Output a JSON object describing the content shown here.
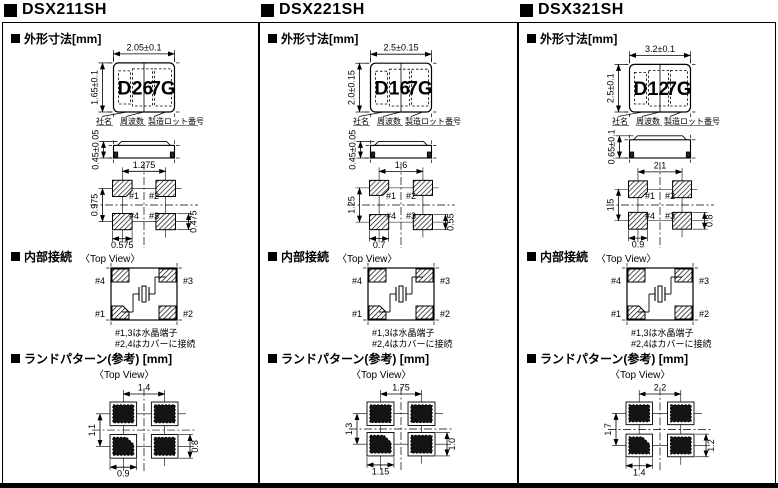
{
  "panels": [
    {
      "title": "DSX211SH",
      "sections": {
        "outline": "外形寸法[mm]",
        "internal": "内部接続",
        "land": "ランドパターン(参考) [mm]"
      },
      "top_view": {
        "width_dim": "2.05±0.1",
        "height_dim": "1.65±0.1",
        "marking": [
          "D",
          "26",
          "7G"
        ],
        "marking_labels": [
          "社名",
          "周波数",
          "製造ロット番号"
        ]
      },
      "side_view": {
        "height_dim": "0.45±0.05"
      },
      "bottom_view": {
        "pitch_x": "1.275",
        "pitch_y": "0.975",
        "pad_width": "0.575",
        "pad_height": "0.475",
        "pins": {
          "top_left": "#1",
          "top_right": "#2",
          "bottom_left": "#4",
          "bottom_right": "#3"
        }
      },
      "internal_view": {
        "label": "〈Top View〉",
        "pins": {
          "top_left": "#4",
          "top_right": "#3",
          "bottom_left": "#1",
          "bottom_right": "#2"
        },
        "notes": [
          "#1,3は水晶端子",
          "#2,4はカバーに接続"
        ]
      },
      "land_pattern": {
        "label": "〈Top View〉",
        "pitch_x": "1.4",
        "pitch_y": "1.1",
        "pad_width": "0.9",
        "pad_height": "0.8"
      }
    },
    {
      "title": "DSX221SH",
      "sections": {
        "outline": "外形寸法[mm]",
        "internal": "内部接続",
        "land": "ランドパターン(参考) [mm]"
      },
      "top_view": {
        "width_dim": "2.5±0.15",
        "height_dim": "2.0±0.15",
        "marking": [
          "D",
          "16",
          "7G"
        ],
        "marking_labels": [
          "社名",
          "周波数",
          "製造ロット番号"
        ]
      },
      "side_view": {
        "height_dim": "0.45±0.05"
      },
      "bottom_view": {
        "pitch_x": "1.6",
        "pitch_y": "1.25",
        "pad_width": "0.7",
        "pad_height": "0.55",
        "pins": {
          "top_left": "#1",
          "top_right": "#2",
          "bottom_left": "#4",
          "bottom_right": "#3"
        }
      },
      "internal_view": {
        "label": "〈Top View〉",
        "pins": {
          "top_left": "#4",
          "top_right": "#3",
          "bottom_left": "#1",
          "bottom_right": "#2"
        },
        "notes": [
          "#1,3は水晶端子",
          "#2,4はカバーに接続"
        ]
      },
      "land_pattern": {
        "label": "〈Top View〉",
        "pitch_x": "1.75",
        "pitch_y": "1.3",
        "pad_width": "1.15",
        "pad_height": "1.0"
      }
    },
    {
      "title": "DSX321SH",
      "sections": {
        "outline": "外形寸法[mm]",
        "internal": "内部接続",
        "land": "ランドパターン(参考) [mm]"
      },
      "top_view": {
        "width_dim": "3.2±0.1",
        "height_dim": "2.5±0.1",
        "marking": [
          "D",
          "12",
          "7G"
        ],
        "marking_labels": [
          "社名",
          "周波数",
          "製造ロット番号"
        ]
      },
      "side_view": {
        "height_dim": "0.65±0.1"
      },
      "bottom_view": {
        "pitch_x": "2.1",
        "pitch_y": "1.5",
        "pad_width": "0.9",
        "pad_height": "0.8",
        "pins": {
          "top_left": "#1",
          "top_right": "#2",
          "bottom_left": "#4",
          "bottom_right": "#3"
        }
      },
      "internal_view": {
        "label": "〈Top View〉",
        "pins": {
          "top_left": "#4",
          "top_right": "#3",
          "bottom_left": "#1",
          "bottom_right": "#2"
        },
        "notes": [
          "#1,3は水晶端子",
          "#2,4はカバーに接続"
        ]
      },
      "land_pattern": {
        "label": "〈Top View〉",
        "pitch_x": "2.2",
        "pitch_y": "1.7",
        "pad_width": "1.4",
        "pad_height": "1.2"
      }
    }
  ]
}
